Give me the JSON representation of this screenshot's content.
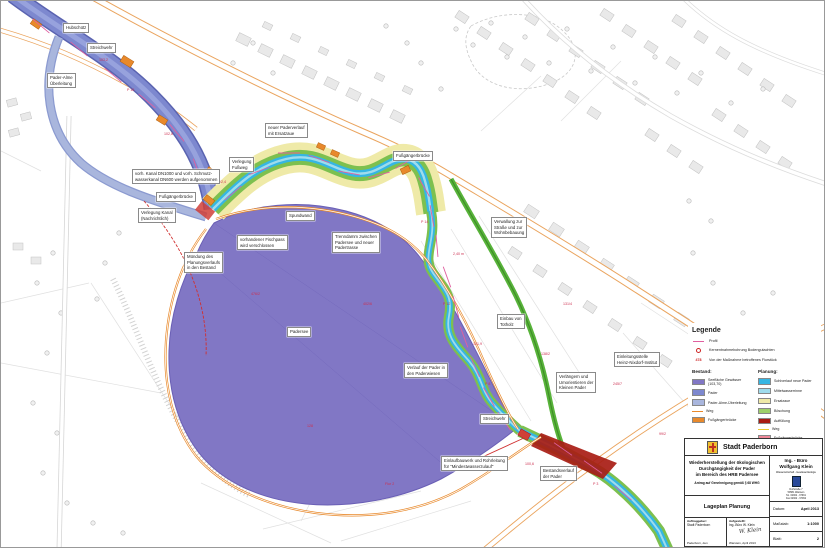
{
  "document": {
    "type": "Lageplan / site plan drawing",
    "scale_note": "1:1000"
  },
  "colors": {
    "lake": "#8177c5",
    "pader_bestand": "#7d88cf",
    "ueberleitung": "#a9b6dd",
    "neue_pader": "#35b6e3",
    "mittelwasserrinne": "#9fdcec",
    "ersatzaue": "#efeaa8",
    "boeschung": "#7dc04f",
    "auffuellung": "#a81c14",
    "weg_bestand": "#e8892b",
    "weg_planung": "#e8c832",
    "fussgaengerbruecke_planung": "#f08898",
    "profil": "#e060a0",
    "annotation_red": "#cc3050"
  },
  "map": {
    "callouts": [
      {
        "x": 62,
        "y": 22,
        "text": "Hubschütz"
      },
      {
        "x": 86,
        "y": 42,
        "text": "Streichwehr"
      },
      {
        "x": 46,
        "y": 72,
        "text": "Pader-Alme\nÜberleitung"
      },
      {
        "x": 264,
        "y": 122,
        "text": "neuer Paderverlauf\nmit Ersatzaue"
      },
      {
        "x": 228,
        "y": 156,
        "text": "Verlegung\nFußweg"
      },
      {
        "x": 392,
        "y": 150,
        "text": "Fußgängerbrücke"
      },
      {
        "x": 131,
        "y": 168,
        "text": "vorh. Kanal DN1000 und vorh. Schmutz-\nwasserkanal DN600 werden aufgenommen"
      },
      {
        "x": 155,
        "y": 191,
        "text": "Fußgängerbrücke"
      },
      {
        "x": 137,
        "y": 207,
        "text": "Verlegung Kanal\n(Nachrichtlich)"
      },
      {
        "x": 285,
        "y": 210,
        "text": "Spundwand"
      },
      {
        "x": 236,
        "y": 234,
        "text": "vorhandener Fischpass\nwird verschlossen"
      },
      {
        "x": 183,
        "y": 251,
        "text": "Mündung des\nPlanungsverlaufs\nin den Bestand"
      },
      {
        "x": 331,
        "y": 231,
        "text": "Trenndamm zwischen\nPadersee und neuer\nPadertrasse"
      },
      {
        "x": 490,
        "y": 216,
        "text": "Verwallung zur\nStraße und zur\nWohnbebauung"
      },
      {
        "x": 496,
        "y": 313,
        "text": "Einbau von\nTotholz"
      },
      {
        "x": 555,
        "y": 371,
        "text": "Verlängern und\nUmorientieren der\nKleinen Pader"
      },
      {
        "x": 613,
        "y": 351,
        "text": "Einleitungsstelle\nHeinz-Nixdorf-Institut"
      },
      {
        "x": 286,
        "y": 326,
        "text": "Padersee"
      },
      {
        "x": 403,
        "y": 362,
        "text": "Verlauf der Pader in\nden Paderwiesen"
      },
      {
        "x": 479,
        "y": 413,
        "text": "Streichwehr"
      },
      {
        "x": 440,
        "y": 455,
        "text": "Einlaufbauwerk und Rohrleitung\nfür \"Mindestwasserzulauf\""
      },
      {
        "x": 539,
        "y": 465,
        "text": "Bestandsverlauf\nder Pader"
      }
    ],
    "annotations": [
      {
        "x": 98,
        "y": 58,
        "text": "103,2"
      },
      {
        "x": 126,
        "y": 88,
        "text": "P 16"
      },
      {
        "x": 163,
        "y": 132,
        "text": "102,8"
      },
      {
        "x": 216,
        "y": 180,
        "text": "102,4"
      },
      {
        "x": 250,
        "y": 292,
        "text": "476/2"
      },
      {
        "x": 306,
        "y": 424,
        "text": "128"
      },
      {
        "x": 362,
        "y": 302,
        "text": "402/6"
      },
      {
        "x": 452,
        "y": 252,
        "text": "2,40 m"
      },
      {
        "x": 442,
        "y": 302,
        "text": "P 12"
      },
      {
        "x": 472,
        "y": 342,
        "text": "101,9"
      },
      {
        "x": 484,
        "y": 382,
        "text": "P 8"
      },
      {
        "x": 562,
        "y": 302,
        "text": "131/4"
      },
      {
        "x": 612,
        "y": 382,
        "text": "245/7"
      },
      {
        "x": 658,
        "y": 432,
        "text": "99/2"
      },
      {
        "x": 384,
        "y": 482,
        "text": "Flur 2"
      },
      {
        "x": 524,
        "y": 462,
        "text": "100,6"
      },
      {
        "x": 592,
        "y": 482,
        "text": "P 3"
      },
      {
        "x": 420,
        "y": 220,
        "text": "P 14"
      },
      {
        "x": 540,
        "y": 352,
        "text": "138/2"
      }
    ]
  },
  "legend": {
    "title": "Legende",
    "symbols": [
      {
        "kind": "profile-line",
        "label": "Profil"
      },
      {
        "kind": "borehole",
        "label": "Kernentnahmebohrung Bodengutachten"
      },
      {
        "kind": "parcel",
        "sample": "478",
        "label": "Von der Maßnahme betroffenes Flurstück"
      }
    ],
    "bestand_title": "Bestand:",
    "planung_title": "Planung:",
    "bestand": [
      {
        "label": "Seefläche Gewässer (103,70)",
        "color": "#8177c5",
        "type": "box"
      },
      {
        "label": "Pader",
        "color": "#7d88cf",
        "type": "box"
      },
      {
        "label": "Pader-Alme-Überleitung",
        "color": "#a9b6dd",
        "type": "box"
      },
      {
        "label": "Weg",
        "color": "#e8892b",
        "type": "line"
      },
      {
        "label": "Fußgängerbrücke",
        "color": "#e8892b",
        "type": "box"
      }
    ],
    "planung": [
      {
        "label": "Sohlverlauf neue Pader",
        "color": "#35b6e3",
        "type": "box"
      },
      {
        "label": "Mittelwasserrinne",
        "color": "#9fdcec",
        "type": "box"
      },
      {
        "label": "Ersatzaue",
        "color": "#efeaa8",
        "type": "box"
      },
      {
        "label": "Böschung",
        "color": "#9ed06a",
        "type": "box"
      },
      {
        "label": "Auffüllung",
        "color": "#a81c14",
        "type": "box"
      },
      {
        "label": "Weg",
        "color": "#e8c832",
        "type": "line"
      },
      {
        "label": "Fußgängerbrücke",
        "color": "#f08898",
        "type": "box"
      }
    ]
  },
  "titleblock": {
    "city": "Stadt Paderborn",
    "project_title": "Wiederherstellung der ökologischen\nDurchgängigkeit der Pader\nim Bereich des HRB Padersee",
    "approval": "Antrag auf Genehmigung gemäß § 68 WHG",
    "plan_name": "Lageplan Planung",
    "office_name": "Ing. - Büro\nWolfgang Klein",
    "office_sub": "Wasserwirtschaft - Gewässerökologie",
    "office_address": "Dorfstraße 7\n59581 Warstein\nTel. 02902 - 97991\nFax 02902 - 97992",
    "client_label": "Auftraggeber:",
    "client": "Stadt Paderborn",
    "client_place": "Paderborn, den",
    "author_label": "Aufgestellt:",
    "author": "Ing.-Büro W. Klein",
    "signature": "W. Klein",
    "author_place": "Warstein, April 2013",
    "date_label": "Datum:",
    "date": "April 2013",
    "scale_label": "Maßstab:",
    "scale": "1:1000",
    "sheet_label": "Blatt:",
    "sheet": "2"
  }
}
